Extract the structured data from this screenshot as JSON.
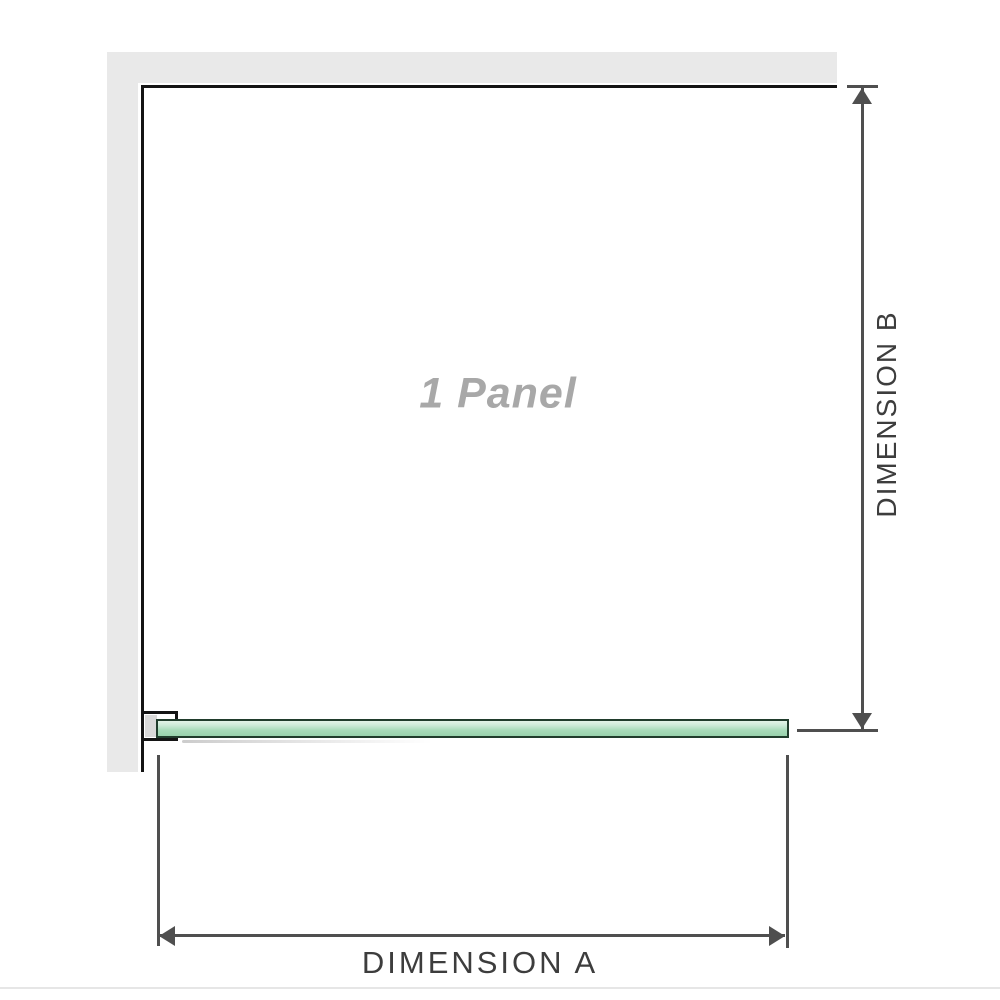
{
  "diagram": {
    "title": "shower-panel-dimension-diagram",
    "panel_label": "1 Panel",
    "dimension_a_label": "DIMENSION A",
    "dimension_b_label": "DIMENSION B"
  },
  "colors": {
    "background": "#ffffff",
    "wall_fill": "#e9e9e9",
    "outline": "#141414",
    "dimension_lines": "#4f4f4f",
    "dimension_text": "#3d3d3d",
    "panel_label_text": "#a8a8a8",
    "bracket_pad": "#d9d9d9",
    "glass_border": "#203c2c",
    "glass_fill_light": "#e3f3e8",
    "glass_fill_main": "#a8dbba"
  }
}
